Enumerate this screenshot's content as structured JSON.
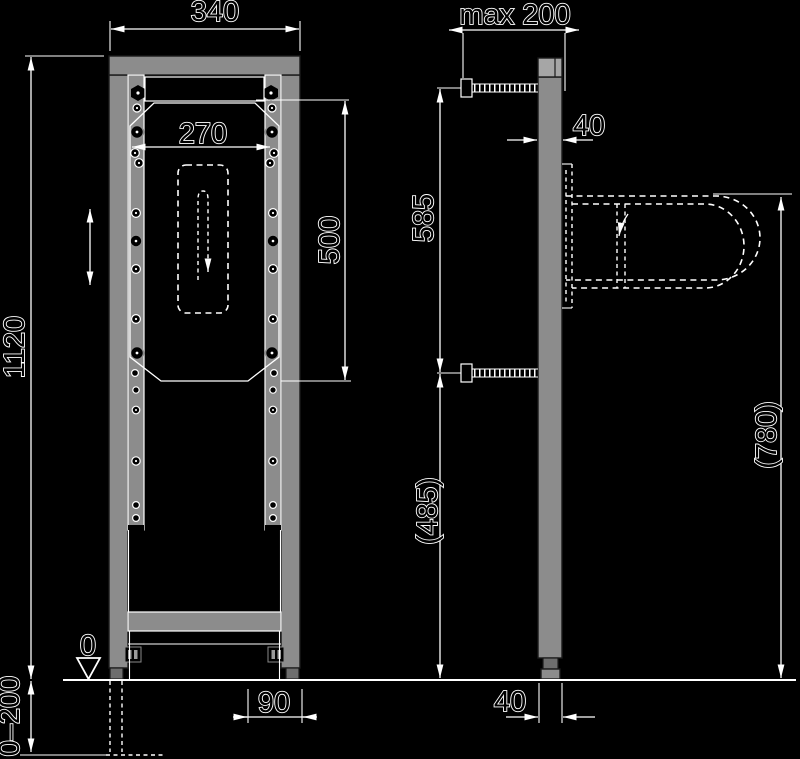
{
  "front_view": {
    "frame_width": "340",
    "inner_width": "270",
    "anchor_span": "500",
    "frame_height": "1120",
    "floor_datum": "0",
    "floor_adjust_range": "0–200",
    "base_width": "90"
  },
  "side_view": {
    "max_wall_distance": "max 200",
    "profile_depth": "40",
    "anchor_spacing": "585",
    "lower_anchor_height": "(485)",
    "basin_rim_height": "(780)",
    "base_depth": "40"
  },
  "colors": {
    "background": "#000000",
    "line": "#ffffff",
    "metal": "#8c8c8c"
  }
}
